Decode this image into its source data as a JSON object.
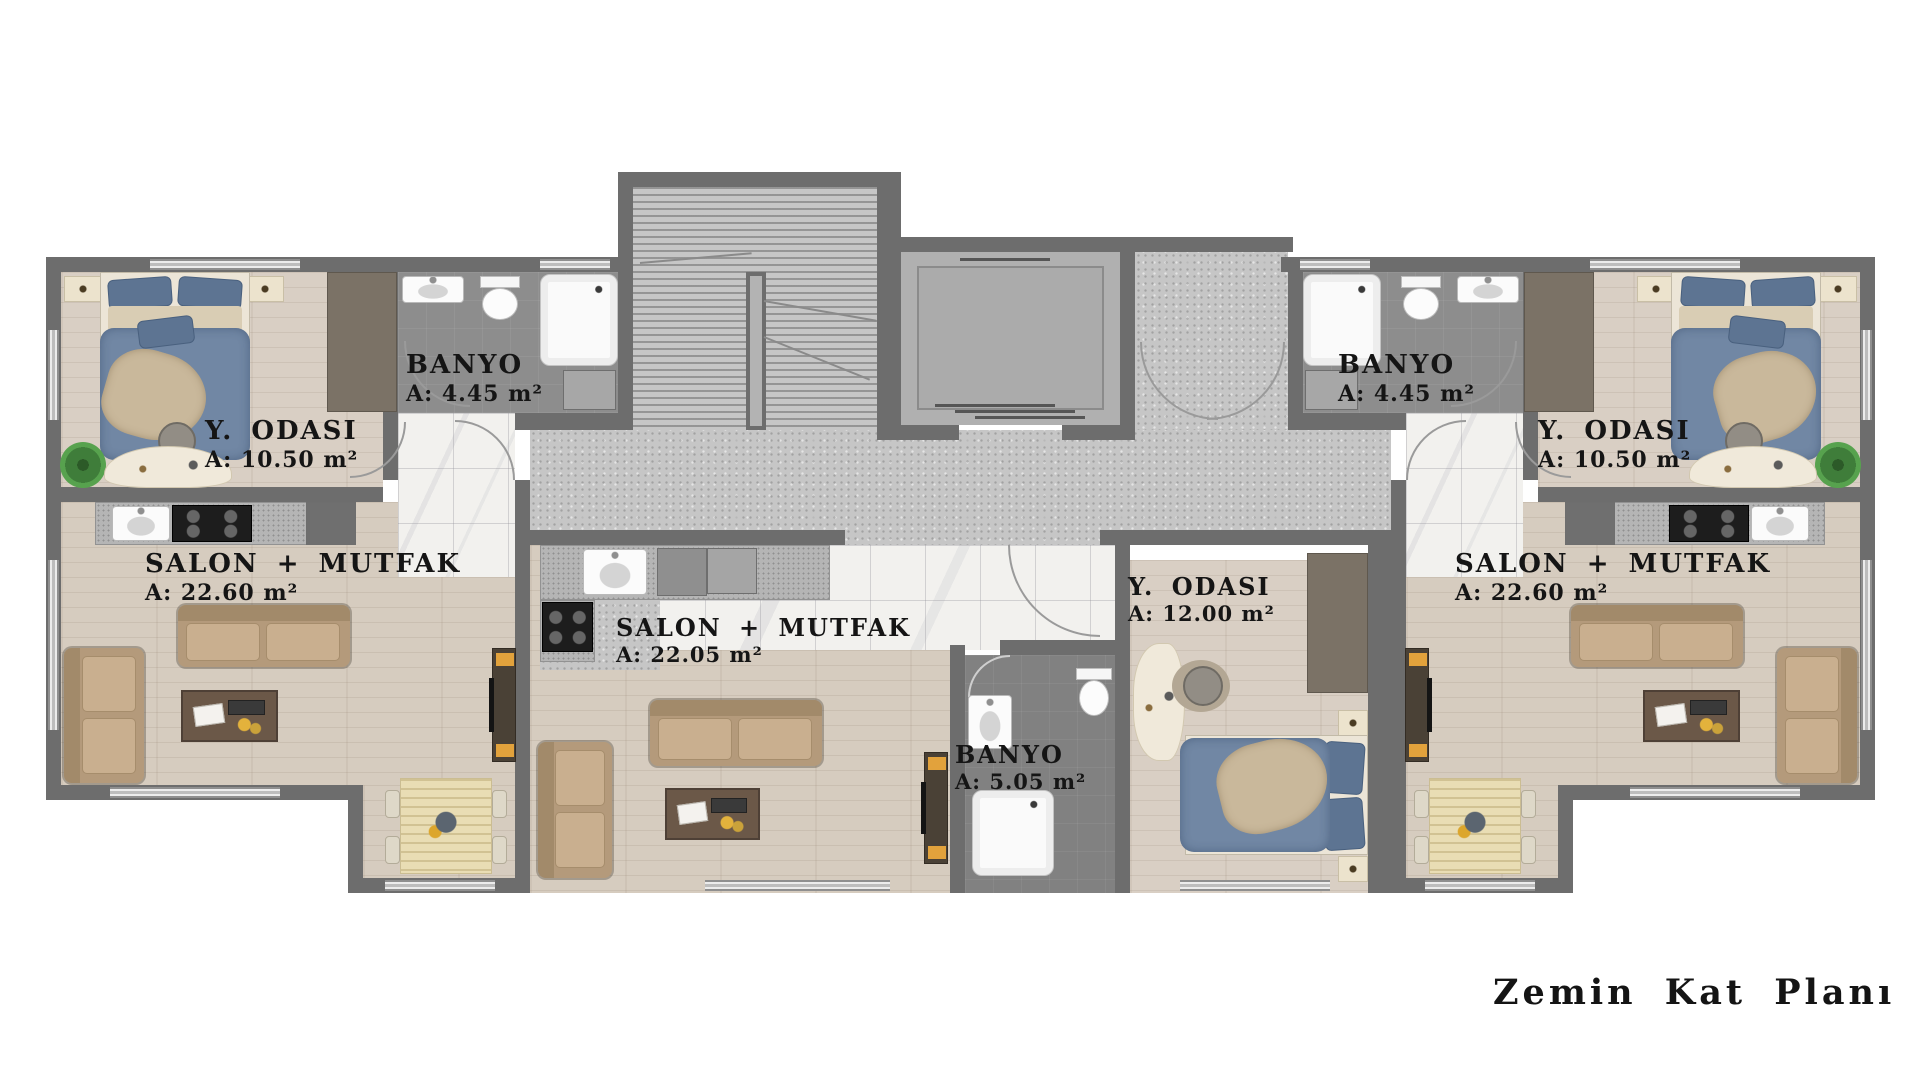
{
  "title": "Zemin Kat Planı",
  "rooms": {
    "left_bedroom": {
      "name": "Y. ODASI",
      "area": "A: 10.50 m²"
    },
    "left_bathroom": {
      "name": "BANYO",
      "area": "A: 4.45 m²"
    },
    "left_salon": {
      "name": "SALON + MUTFAK",
      "area": "A: 22.60 m²"
    },
    "middle_salon": {
      "name": "SALON + MUTFAK",
      "area": "A: 22.05 m²"
    },
    "middle_bathroom": {
      "name": "BANYO",
      "area": "A: 5.05 m²"
    },
    "middle_bedroom": {
      "name": "Y. ODASI",
      "area": "A: 12.00 m²"
    },
    "right_bathroom": {
      "name": "BANYO",
      "area": "A: 4.45 m²"
    },
    "right_bedroom": {
      "name": "Y. ODASI",
      "area": "A: 10.50 m²"
    },
    "right_salon": {
      "name": "SALON + MUTFAK",
      "area": "A: 22.60 m²"
    }
  },
  "colors": {
    "wall": "#6d6d6d",
    "wood_floor": "#d6ccbf",
    "marble_floor": "#f2f1ee",
    "bathroom_tile": "#8d8d8d",
    "corridor_concrete": "#c6c6c6",
    "bed_blue": "#7187a4",
    "sofa_tan": "#b49a7b",
    "accent_orange": "#e2a23c",
    "plant_green": "#3f7d3a",
    "label_text": "#151515"
  }
}
